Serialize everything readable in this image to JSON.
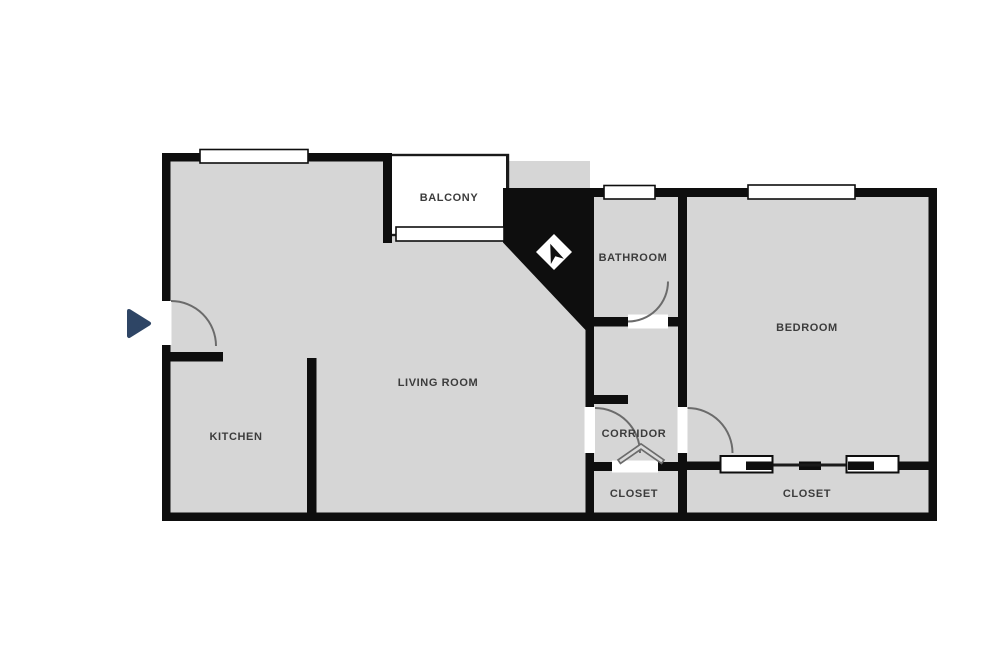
{
  "title": "Apartment floor plan",
  "colors": {
    "floor": "#d6d6d6",
    "wall": "#0e0e0e",
    "door_arc": "#6b6b6b",
    "entry_arrow": "#2e4565",
    "label_text": "#3c3c3c"
  },
  "rooms": [
    {
      "id": "balcony",
      "label": "BALCONY"
    },
    {
      "id": "bathroom",
      "label": "BATHROOM"
    },
    {
      "id": "bedroom",
      "label": "BEDROOM"
    },
    {
      "id": "living-room",
      "label": "LIVING ROOM"
    },
    {
      "id": "kitchen",
      "label": "KITCHEN"
    },
    {
      "id": "corridor",
      "label": "CORRIDOR"
    },
    {
      "id": "closet-hall",
      "label": "CLOSET"
    },
    {
      "id": "closet-bedroom",
      "label": "CLOSET"
    }
  ],
  "icons": [
    {
      "name": "entry-arrow-icon"
    },
    {
      "name": "compass-icon"
    }
  ]
}
